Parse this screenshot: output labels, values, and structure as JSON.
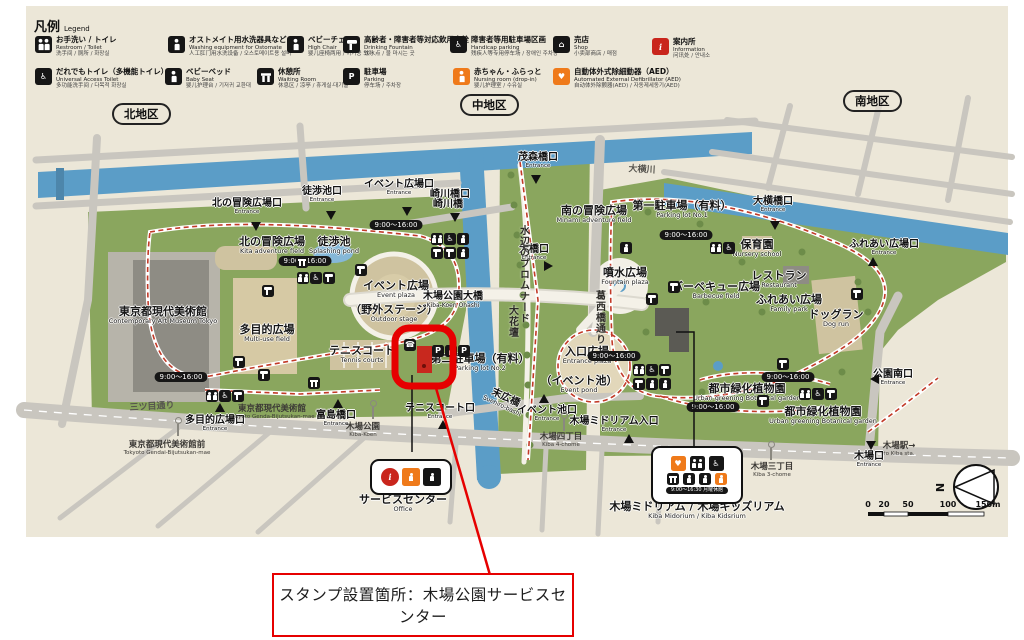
{
  "legend": {
    "title_jp": "凡例",
    "title_en": "Legend",
    "items": [
      {
        "icon": "toilet",
        "jp": "お手洗い / トイレ",
        "en": "Restroom / Toilet",
        "sub": "洗手间 / 厕所 / 화장실"
      },
      {
        "icon": "person",
        "jp": "オストメイト用水洗器具など",
        "en": "Washing equipment for Ostomate",
        "sub": "人工肛门用水洗设备 / 오스토메이트용 설비"
      },
      {
        "icon": "highchair",
        "jp": "ベビーチェア",
        "en": "High Chair",
        "sub": "婴儿座椅两用 / 아기용 의자"
      },
      {
        "icon": "faucet",
        "jp": "高齢者・障害者等対応飲用水栓",
        "en": "Drinking Fountain",
        "sub": "饮水点 / 물 마시는 곳"
      },
      {
        "icon": "wheelchair",
        "jp": "障害者等用駐車場区画",
        "en": "Handicap parking",
        "sub": "残疾人等专用停车场 / 장애인 주차장"
      },
      {
        "icon": "shop",
        "jp": "売店",
        "en": "Shop",
        "sub": "小卖部商店 / 매점"
      },
      {
        "icon": "info",
        "jp": "案内所",
        "en": "Information",
        "sub": "问讯处 / 안내소"
      },
      {
        "icon": "universal",
        "jp": "だれでもトイレ（多機能トイレ）",
        "en": "Universal Access Toilet",
        "sub": "多功能洗手间 / 다목적 화장실"
      },
      {
        "icon": "babybed",
        "jp": "ベビーベッド",
        "en": "Baby Seat",
        "sub": "婴儿护理台 / 기저귀 교환대"
      },
      {
        "icon": "bench",
        "jp": "休憩所",
        "en": "Waiting Room",
        "sub": "休息区 / 凉亭 / 휴게실·대기실"
      },
      {
        "icon": "parking",
        "jp": "駐車場",
        "en": "Parking",
        "sub": "停车场 / 주차장"
      },
      {
        "icon": "baby",
        "jp": "赤ちゃん・ふらっと",
        "en": "Nursing room (drop-in)",
        "sub": "婴儿护理室 / 수유실"
      },
      {
        "icon": "aed",
        "jp": "自動体外式除細動器（AED）",
        "en": "Automated External Defibrillator (AED)",
        "sub": "自动体外除颤器(AED) / 자동제세동기(AED)"
      }
    ]
  },
  "districts": [
    "北地区",
    "中地区",
    "南地区"
  ],
  "map": {
    "areas": [
      {
        "jp": "東京都現代美術館",
        "en": "Contemporary Art Museum Tokyo"
      },
      {
        "jp": "北の冒険広場",
        "en": "Kita adventure field"
      },
      {
        "jp": "徒渉池",
        "en": "Splashing pond"
      },
      {
        "jp": "多目的広場",
        "en": "Multi-use field"
      },
      {
        "jp": "イベント広場",
        "en": "Event plaza"
      },
      {
        "jp": "（野外ステージ）",
        "en": "Outdoor stage"
      },
      {
        "jp": "テニスコート",
        "en": "Tennis courts"
      },
      {
        "jp": "第二駐車場（有料）",
        "en": "Parking lot No.2"
      },
      {
        "jp": "南の冒険広場",
        "en": "Minami adventure field"
      },
      {
        "jp": "第一駐車場（有料）",
        "en": "Parking lot No.1"
      },
      {
        "jp": "噴水広場",
        "en": "Fountain plaza"
      },
      {
        "jp": "バーベキュー広場",
        "en": "Barbecue field"
      },
      {
        "jp": "レストラン",
        "en": "Restaurant"
      },
      {
        "jp": "ふれあい広場",
        "en": "Family park"
      },
      {
        "jp": "ドッグラン",
        "en": "Dog run"
      },
      {
        "jp": "保育園",
        "en": "Nursery school"
      },
      {
        "jp": "入口広場",
        "en": "Entrance plaza"
      },
      {
        "jp": "（イベント池）",
        "en": "Event pond"
      },
      {
        "jp": "都市緑化植物園",
        "en": "Urban greening Botanical garden"
      },
      {
        "jp": "都市緑化植物園",
        "en": "Urban greening Botanical garden"
      },
      {
        "jp": "木場ミドリアム / 木場キッズリアム",
        "en": "Kiba Midorium / Kiba Kidsrium"
      },
      {
        "jp": "サービスセンター",
        "en": "Office"
      }
    ],
    "entrances": [
      {
        "jp": "北の冒険広場口",
        "en": "Entrance"
      },
      {
        "jp": "徒渉池口",
        "en": "Entrance"
      },
      {
        "jp": "イベント広場口",
        "en": "Entrance"
      },
      {
        "jp": "崎川橋口",
        "en": "Entrance"
      },
      {
        "jp": "茂森橋口",
        "en": "Entrance"
      },
      {
        "jp": "大橋口",
        "en": "Entrance"
      },
      {
        "jp": "大横橋口",
        "en": "Entrance"
      },
      {
        "jp": "ふれあい広場口",
        "en": "Entrance"
      },
      {
        "jp": "公園南口",
        "en": "Entrance"
      },
      {
        "jp": "木場口",
        "en": "Entrance"
      },
      {
        "jp": "多目的広場口",
        "en": "Entrance"
      },
      {
        "jp": "富島橋口",
        "en": "Entrance"
      },
      {
        "jp": "テニスコート口",
        "en": "Entrance"
      },
      {
        "jp": "イベント池口",
        "en": "Entrance"
      },
      {
        "jp": "木場ミドリアム入口",
        "en": "Entrance"
      }
    ],
    "stops": [
      {
        "jp": "東京都現代美術館前",
        "en": "Tokyoto Gendai-Bijutsukan-mae"
      },
      {
        "jp": "木場公園",
        "en": "Kiba-Koen"
      },
      {
        "jp": "東京都現代美術館",
        "en": "Tokyoto Genda-Bijutsukan-mae"
      },
      {
        "jp": "木場四丁目",
        "en": "Kiba 4-chome"
      },
      {
        "jp": "木場三丁目",
        "en": "Kiba 3-chome"
      },
      {
        "jp": "木場駅→",
        "en": "to Kiba sta."
      }
    ],
    "linear_labels": [
      {
        "name": "三ツ目通り"
      },
      {
        "name": "葛西橋通り"
      },
      {
        "name": "水辺のプロムナード"
      },
      {
        "name": "大花壇"
      },
      {
        "name": "大横川"
      }
    ],
    "bridges": [
      {
        "jp": "崎川橋",
        "en": ""
      },
      {
        "jp": "木場公園大橋",
        "en": "Kiba-Koen Ohashi"
      },
      {
        "jp": "末広橋",
        "en": "Suehiro-bashi"
      }
    ],
    "time_badges": [
      "9:00～16:00",
      "9:00～16:00",
      "9:00～16:00",
      "9:00～16:00",
      "9:00～16:00",
      "9:00～16:00",
      "9:00～16:00"
    ],
    "icons": [
      {
        "type": "faucet"
      },
      {
        "type": "faucet"
      },
      {
        "type": "faucet"
      },
      {
        "type": "faucet"
      },
      {
        "type": "faucet"
      },
      {
        "type": "faucet"
      },
      {
        "type": "faucet"
      },
      {
        "type": "faucet"
      },
      {
        "type": "faucet"
      },
      {
        "type": "person"
      },
      {
        "type": "bench"
      },
      {
        "type": "bench"
      },
      {
        "type": "phone"
      },
      {
        "type": "toilet"
      },
      {
        "type": "wheelchair"
      },
      {
        "type": "person"
      },
      {
        "type": "faucet"
      },
      {
        "type": "faucet"
      },
      {
        "type": "person"
      },
      {
        "type": "toilet"
      },
      {
        "type": "wheelchair"
      },
      {
        "type": "faucet"
      },
      {
        "type": "toilet"
      },
      {
        "type": "wheelchair"
      },
      {
        "type": "faucet"
      },
      {
        "type": "toilet"
      },
      {
        "type": "wheelchair"
      },
      {
        "type": "faucet"
      },
      {
        "type": "faucet"
      },
      {
        "type": "person"
      },
      {
        "type": "person"
      },
      {
        "type": "toilet"
      },
      {
        "type": "wheelchair"
      },
      {
        "type": "faucet"
      },
      {
        "type": "toilet"
      },
      {
        "type": "wheelchair"
      },
      {
        "type": "parking"
      },
      {
        "type": "person"
      },
      {
        "type": "parking"
      }
    ],
    "facilities": {
      "midorium_hours": "9:00～16:30 月曜休館"
    },
    "scale": {
      "ticks": [
        "0",
        "20",
        "50",
        "100",
        "150m"
      ]
    },
    "compass": "N"
  },
  "glyphs": {
    "parking": "P",
    "info": "i",
    "aed": "♥",
    "phone": "☎",
    "wheelchair": "♿",
    "shop": "⌂",
    "north": "N"
  },
  "callout": {
    "text": "スタンプ設置箇所：木場公園サービスセンター"
  }
}
